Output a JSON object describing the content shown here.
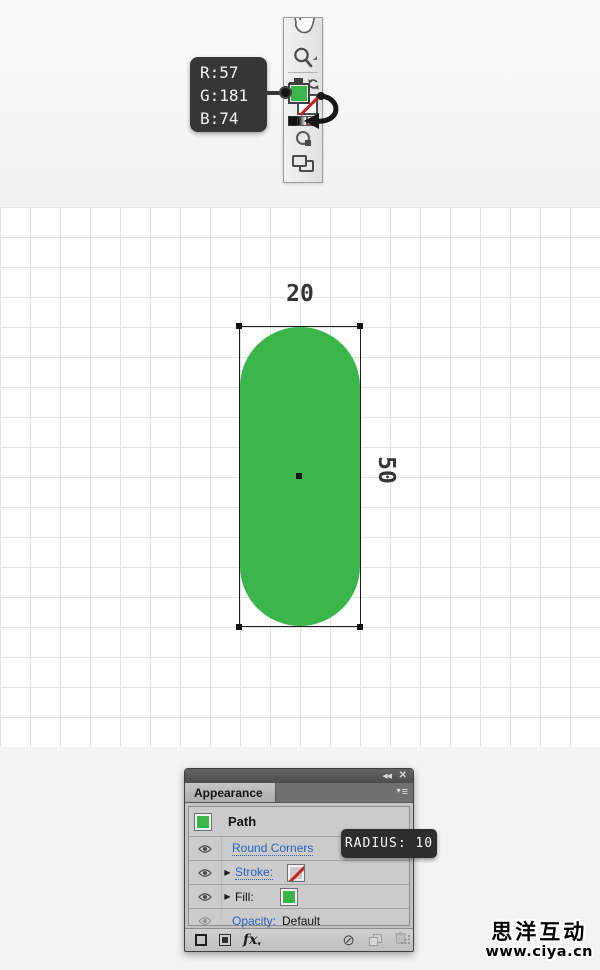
{
  "colors": {
    "fill_green": "#39b54a",
    "tooltip_bg": "#363636",
    "link_blue": "#2b5fc0",
    "none_slash_red": "#cc1f1f"
  },
  "rgb_tooltip": {
    "r": "R:57",
    "g": "G:181",
    "b": "B:74"
  },
  "canvas": {
    "width_label": "20",
    "height_label": "50"
  },
  "appearance_panel": {
    "tab_label": "Appearance",
    "rows": {
      "path": {
        "label": "Path"
      },
      "round_corners": {
        "label": "Round Corners"
      },
      "stroke": {
        "label": "Stroke:"
      },
      "fill": {
        "label": "Fill:"
      },
      "opacity": {
        "label": "Opacity:",
        "value": "Default"
      }
    }
  },
  "radius_tooltip": {
    "text": "RADIUS: 10"
  },
  "watermark": {
    "line1": "思洋互动",
    "line2": "www.ciya.cn"
  },
  "icons": {
    "collapse": "◀◀",
    "close": "✕",
    "panel_menu_triangle": "▾",
    "panel_menu_lines": "≡",
    "expand_triangle": "▶",
    "clear_appearance": "⊘",
    "effect": "fx",
    "effect_caret": "▾"
  }
}
